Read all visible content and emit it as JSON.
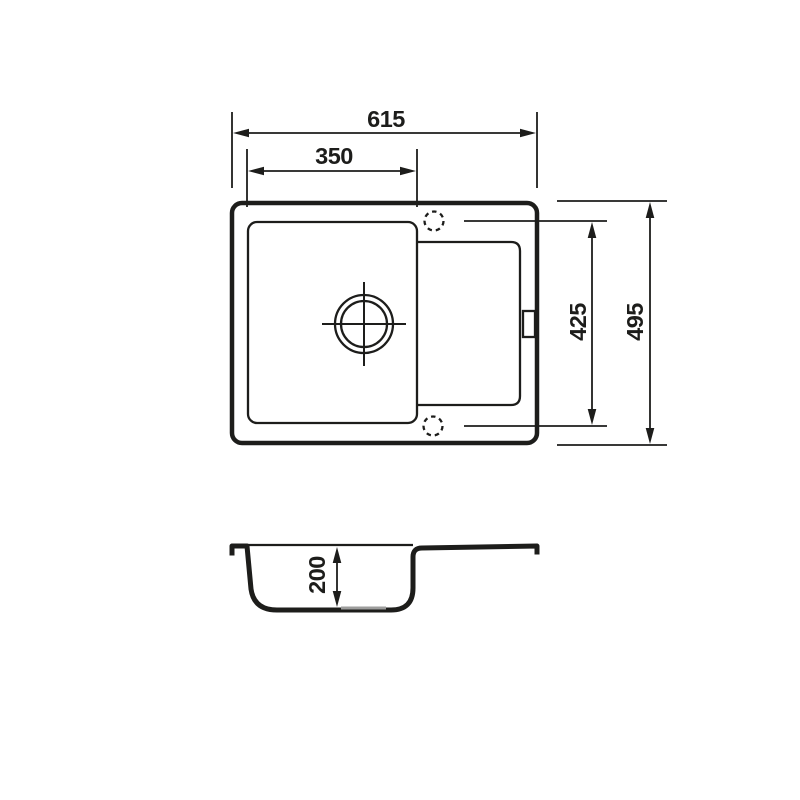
{
  "drawing": {
    "dimensions": {
      "overall_width": "615",
      "bowl_width": "350",
      "tap_hole_span": "425",
      "overall_depth": "495",
      "bowl_depth": "200"
    },
    "colors": {
      "line": "#1d1d1b",
      "background": "#ffffff",
      "drain-mark": "#9d9d9c"
    }
  }
}
